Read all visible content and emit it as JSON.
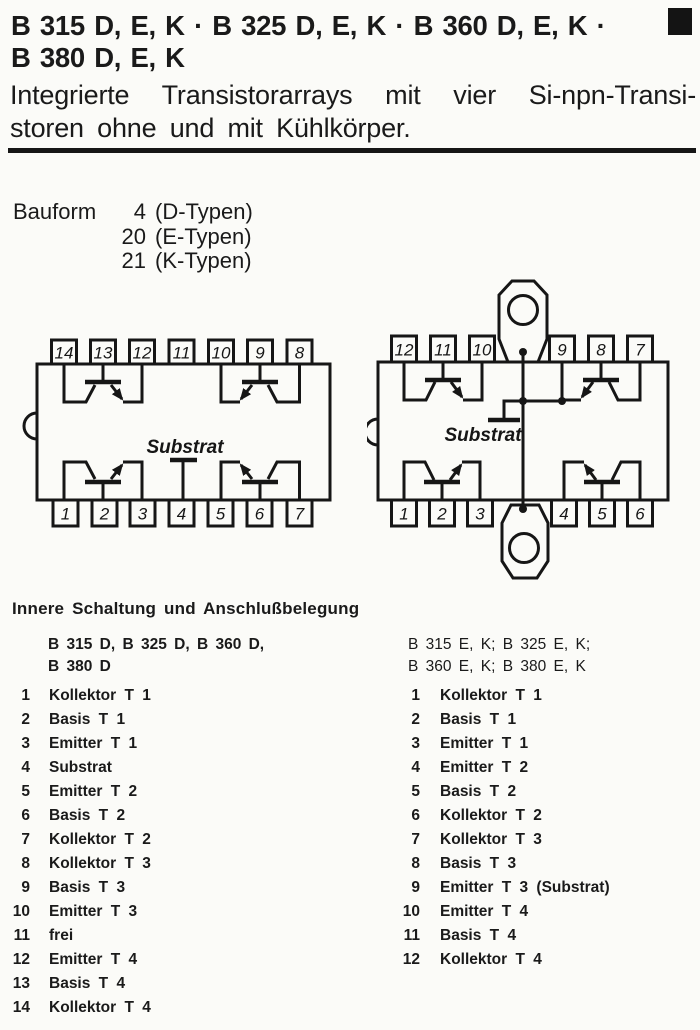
{
  "header": {
    "title_line1": "B 315 D, E, K  ·  B 325 D, E, K  ·  B 360 D, E, K  ·",
    "title_line2": "B 380 D, E, K",
    "subtitle_line1": "Integrierte Transistorarrays mit vier Si-npn-Transi-",
    "subtitle_line2": "storen ohne und mit Kühlkörper."
  },
  "bauform": {
    "label": "Bauform",
    "rows": [
      {
        "num": "4",
        "type": "(D-Typen)"
      },
      {
        "num": "20",
        "type": "(E-Typen)"
      },
      {
        "num": "21",
        "type": "(K-Typen)"
      }
    ]
  },
  "diagrams": {
    "left": {
      "pins_top": [
        "14",
        "13",
        "12",
        "11",
        "10",
        "9",
        "8"
      ],
      "pins_bottom": [
        "1",
        "2",
        "3",
        "4",
        "5",
        "6",
        "7"
      ],
      "substrate_label": "Substrat"
    },
    "right": {
      "pins_top": [
        "12",
        "11",
        "10",
        "9",
        "8",
        "7"
      ],
      "pins_bottom": [
        "1",
        "2",
        "3",
        "4",
        "5",
        "6"
      ],
      "substrate_label": "Substrat"
    }
  },
  "pinout": {
    "heading": "Innere Schaltung und Anschlußbelegung",
    "left": {
      "title_line1": "B 315 D, B 325 D, B 360 D,",
      "title_line2": "B 380 D",
      "items": [
        {
          "pin": "1",
          "label": "Kollektor T 1"
        },
        {
          "pin": "2",
          "label": "Basis T 1"
        },
        {
          "pin": "3",
          "label": "Emitter T 1"
        },
        {
          "pin": "4",
          "label": "Substrat"
        },
        {
          "pin": "5",
          "label": "Emitter T 2"
        },
        {
          "pin": "6",
          "label": "Basis T 2"
        },
        {
          "pin": "7",
          "label": "Kollektor T 2"
        },
        {
          "pin": "8",
          "label": "Kollektor T 3"
        },
        {
          "pin": "9",
          "label": "Basis T 3"
        },
        {
          "pin": "10",
          "label": "Emitter T 3"
        },
        {
          "pin": "11",
          "label": "frei"
        },
        {
          "pin": "12",
          "label": "Emitter T 4"
        },
        {
          "pin": "13",
          "label": "Basis T 4"
        },
        {
          "pin": "14",
          "label": "Kollektor T 4"
        }
      ]
    },
    "right": {
      "title_line1": "B 315 E, K; B 325 E, K;",
      "title_line2": "B 360 E, K; B 380 E, K",
      "items": [
        {
          "pin": "1",
          "label": "Kollektor T 1"
        },
        {
          "pin": "2",
          "label": "Basis T 1"
        },
        {
          "pin": "3",
          "label": "Emitter T 1"
        },
        {
          "pin": "4",
          "label": "Emitter T 2"
        },
        {
          "pin": "5",
          "label": "Basis T 2"
        },
        {
          "pin": "6",
          "label": "Kollektor T 2"
        },
        {
          "pin": "7",
          "label": "Kollektor T 3"
        },
        {
          "pin": "8",
          "label": "Basis T 3"
        },
        {
          "pin": "9",
          "label": "Emitter T 3 (Substrat)"
        },
        {
          "pin": "10",
          "label": "Emitter T 4"
        },
        {
          "pin": "11",
          "label": "Basis T 4"
        },
        {
          "pin": "12",
          "label": "Kollektor T 4"
        }
      ]
    }
  },
  "colors": {
    "ink": "#161616",
    "paper": "#fbfbf8"
  }
}
